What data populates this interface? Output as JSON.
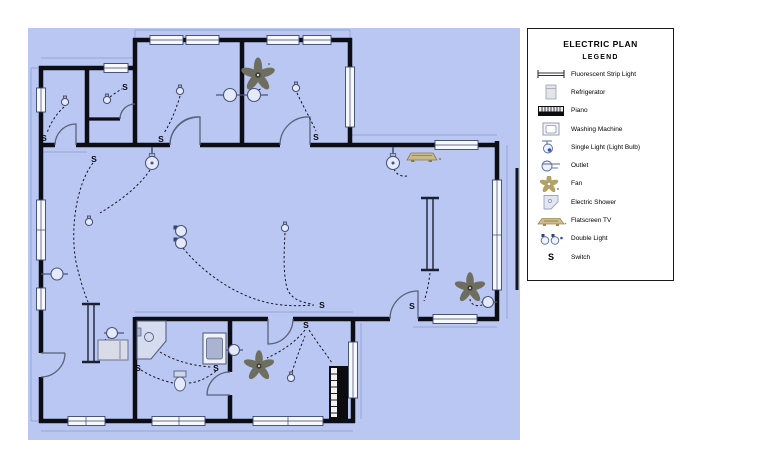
{
  "legend": {
    "title": "ELECTRIC PLAN",
    "subtitle": "LEGEND",
    "items": [
      {
        "icon": "fluorescent-strip-light-icon",
        "label": "Fluorescent Strip Light"
      },
      {
        "icon": "refrigerator-icon",
        "label": "Refrigerator"
      },
      {
        "icon": "piano-icon",
        "label": "Piano"
      },
      {
        "icon": "washing-machine-icon",
        "label": "Washing Machine"
      },
      {
        "icon": "single-light-icon",
        "label": "Single Light (Light Bulb)"
      },
      {
        "icon": "outlet-icon",
        "label": "Outlet"
      },
      {
        "icon": "fan-icon",
        "label": "Fan"
      },
      {
        "icon": "electric-shower-icon",
        "label": "Electric Shower"
      },
      {
        "icon": "flatscreen-tv-icon",
        "label": "Flatscreen TV"
      },
      {
        "icon": "double-light-icon",
        "label": "Double Light"
      },
      {
        "icon": "switch-symbol",
        "label": "Switch"
      }
    ]
  },
  "plan": {
    "background_color": "#b9c7f2",
    "wall_color": "#0d0d16",
    "wire_color": "#14141e",
    "fan_color": "#6e6e60",
    "tv_color": "#c9b987",
    "switch_label": "S",
    "switches": [
      {
        "x": 44,
        "y": 141
      },
      {
        "x": 125,
        "y": 90
      },
      {
        "x": 161,
        "y": 142
      },
      {
        "x": 316,
        "y": 140
      },
      {
        "x": 94,
        "y": 162
      },
      {
        "x": 322,
        "y": 308
      },
      {
        "x": 306,
        "y": 328
      },
      {
        "x": 412,
        "y": 309
      },
      {
        "x": 138,
        "y": 371
      },
      {
        "x": 216,
        "y": 371
      }
    ]
  }
}
